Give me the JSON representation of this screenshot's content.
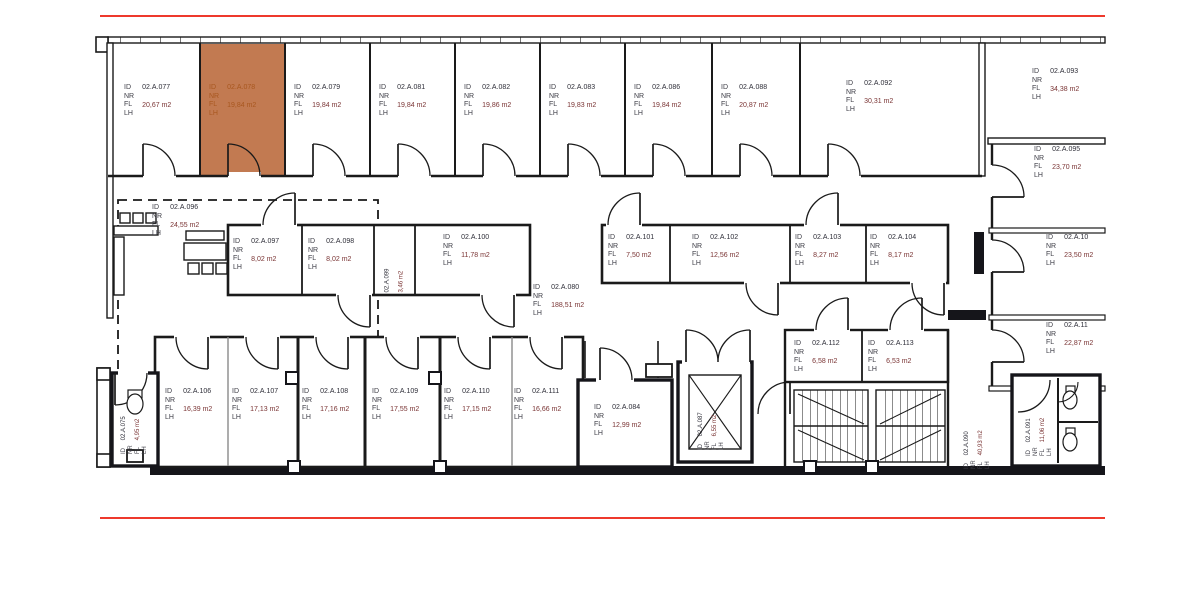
{
  "fields": "ID\nNR\nFL\nLH",
  "highlighted_room": "02.A.078",
  "colors": {
    "highlight_fill": "#bf7348",
    "highlight_text": "#a8571f",
    "frame_red": "#ee392c",
    "window_blue": "#3f9fd0",
    "wall": "#1a1a1a",
    "area_text": "#7a3434",
    "id_text": "#2e2e38"
  },
  "rooms": {
    "r077": {
      "id": "02.A.077",
      "area": "20,67 m2"
    },
    "r078": {
      "id": "02.A.078",
      "area": "19,84 m2"
    },
    "r079": {
      "id": "02.A.079",
      "area": "19,84 m2"
    },
    "r081": {
      "id": "02.A.081",
      "area": "19,84 m2"
    },
    "r082": {
      "id": "02.A.082",
      "area": "19,86 m2"
    },
    "r083": {
      "id": "02.A.083",
      "area": "19,83 m2"
    },
    "r086": {
      "id": "02.A.086",
      "area": "19,84 m2"
    },
    "r088": {
      "id": "02.A.088",
      "area": "20,87 m2"
    },
    "r092": {
      "id": "02.A.092",
      "area": "30,31 m2"
    },
    "r093": {
      "id": "02.A.093",
      "area": "34,38 m2"
    },
    "r095": {
      "id": "02.A.095",
      "area": "23,70 m2"
    },
    "r105": {
      "id": "02.A.10",
      "area": "23,50 m2"
    },
    "r114": {
      "id": "02.A.11",
      "area": "22,87 m2"
    },
    "r096": {
      "id": "02.A.096",
      "area": "24,55 m2"
    },
    "r097": {
      "id": "02.A.097",
      "area": "8,02 m2"
    },
    "r098": {
      "id": "02.A.098",
      "area": "8,02 m2"
    },
    "r099": {
      "id": "02.A.099",
      "area": "3,46 m2"
    },
    "r100": {
      "id": "02.A.100",
      "area": "11,78 m2"
    },
    "r080": {
      "id": "02.A.080",
      "area": "188,51 m2"
    },
    "r101": {
      "id": "02.A.101",
      "area": "7,50 m2"
    },
    "r102": {
      "id": "02.A.102",
      "area": "12,56 m2"
    },
    "r103": {
      "id": "02.A.103",
      "area": "8,27 m2"
    },
    "r104": {
      "id": "02.A.104",
      "area": "8,17 m2"
    },
    "r106": {
      "id": "02.A.106",
      "area": "16,39 m2"
    },
    "r107": {
      "id": "02.A.107",
      "area": "17,13 m2"
    },
    "r108": {
      "id": "02.A.108",
      "area": "17,16 m2"
    },
    "r109": {
      "id": "02.A.109",
      "area": "17,55 m2"
    },
    "r110": {
      "id": "02.A.110",
      "area": "17,15 m2"
    },
    "r111": {
      "id": "02.A.111",
      "area": "16,66 m2"
    },
    "r084": {
      "id": "02.A.084",
      "area": "12,99 m2"
    },
    "r087": {
      "id": "02.A.087",
      "area": "6,55 m2"
    },
    "r112": {
      "id": "02.A.112",
      "area": "6,58 m2"
    },
    "r113": {
      "id": "02.A.113",
      "area": "6,53 m2"
    },
    "r090": {
      "id": "02.A.090",
      "area": "40,93 m2"
    },
    "r091": {
      "id": "02.A.091",
      "area": "11,06 m2"
    },
    "r075": {
      "id": "02.A.075",
      "area": "4,95 m2"
    }
  }
}
